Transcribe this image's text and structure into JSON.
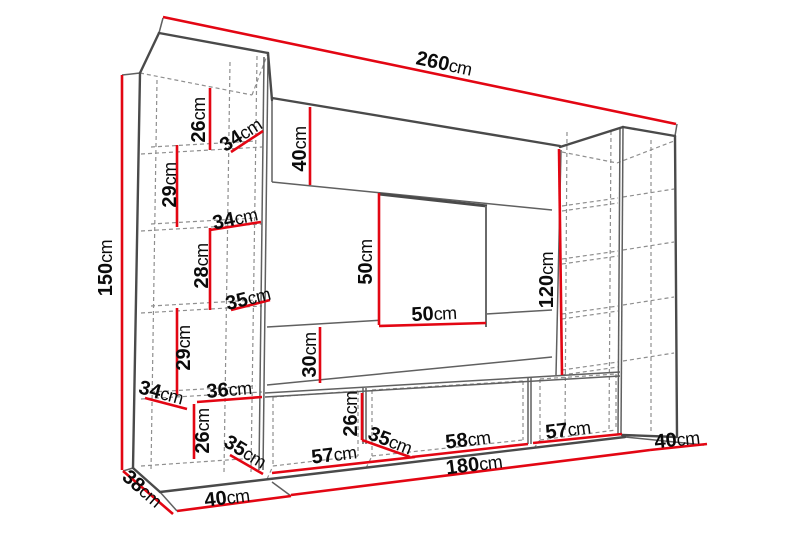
{
  "diagram": {
    "unit": "cm",
    "colors": {
      "dimension_line": "#e30613",
      "outline": "#4a4a4a",
      "outline_thin": "#606060",
      "hidden_line": "#8f8f8f",
      "label_text": "#0b0b0b",
      "background": "#ffffff"
    },
    "dimensions": [
      {
        "id": "overall-width",
        "value": "260",
        "unit": "cm",
        "x": 444,
        "y": 64,
        "rot": 12,
        "line": [
          163,
          17,
          676,
          124
        ]
      },
      {
        "id": "overall-height",
        "value": "150",
        "unit": "cm",
        "x": 106,
        "y": 268,
        "rot": -90,
        "line": [
          122,
          75,
          122,
          470
        ]
      },
      {
        "id": "left-shelf-26",
        "value": "26",
        "unit": "cm",
        "x": 199,
        "y": 120,
        "rot": -90,
        "line": [
          210,
          88,
          210,
          150
        ]
      },
      {
        "id": "left-depth-34a",
        "value": "34",
        "unit": "cm",
        "x": 241,
        "y": 135,
        "rot": -33,
        "line": [
          231,
          152,
          263,
          131
        ]
      },
      {
        "id": "top-panel-40",
        "value": "40",
        "unit": "cm",
        "x": 300,
        "y": 149,
        "rot": -90,
        "line": [
          310,
          107,
          310,
          185
        ]
      },
      {
        "id": "left-shelf-29a",
        "value": "29",
        "unit": "cm",
        "x": 170,
        "y": 185,
        "rot": -90,
        "line": [
          177,
          145,
          177,
          227
        ]
      },
      {
        "id": "left-depth-34b",
        "value": "34",
        "unit": "cm",
        "x": 235,
        "y": 219,
        "rot": -12,
        "line": [
          210,
          230,
          261,
          222
        ]
      },
      {
        "id": "left-shelf-28",
        "value": "28",
        "unit": "cm",
        "x": 202,
        "y": 266,
        "rot": -90,
        "line": [
          210,
          228,
          210,
          310
        ]
      },
      {
        "id": "left-depth-35a",
        "value": "35",
        "unit": "cm",
        "x": 248,
        "y": 299,
        "rot": -14,
        "line": [
          231,
          310,
          270,
          300
        ]
      },
      {
        "id": "tv-height-50",
        "value": "50",
        "unit": "cm",
        "x": 366,
        "y": 262,
        "rot": -90,
        "line": [
          379,
          193,
          379,
          325
        ]
      },
      {
        "id": "tv-width-50",
        "value": "50",
        "unit": "cm",
        "x": 434,
        "y": 314,
        "rot": -3,
        "line": [
          379,
          326,
          486,
          323
        ]
      },
      {
        "id": "right-cabinet-120",
        "value": "120",
        "unit": "cm",
        "x": 547,
        "y": 280,
        "rot": -90,
        "line": [
          559,
          149,
          562,
          375
        ]
      },
      {
        "id": "left-shelf-29b",
        "value": "29",
        "unit": "cm",
        "x": 184,
        "y": 348,
        "rot": -90,
        "line": [
          177,
          308,
          177,
          395
        ]
      },
      {
        "id": "lower-panel-30",
        "value": "30",
        "unit": "cm",
        "x": 310,
        "y": 355,
        "rot": -90,
        "line": [
          320,
          327,
          320,
          383
        ]
      },
      {
        "id": "left-bottom-depth-34",
        "value": "34",
        "unit": "cm",
        "x": 161,
        "y": 393,
        "rot": 15,
        "line": [
          145,
          398,
          187,
          409
        ]
      },
      {
        "id": "left-bottom-width-36",
        "value": "36",
        "unit": "cm",
        "x": 229,
        "y": 390,
        "rot": -5,
        "line": [
          197,
          402,
          262,
          397
        ]
      },
      {
        "id": "left-bottom-height-26",
        "value": "26",
        "unit": "cm",
        "x": 203,
        "y": 431,
        "rot": -90,
        "line": [
          194,
          404,
          194,
          459
        ]
      },
      {
        "id": "bench-left-depth-35",
        "value": "35",
        "unit": "cm",
        "x": 245,
        "y": 452,
        "rot": 31,
        "line": [
          230,
          455,
          263,
          474
        ]
      },
      {
        "id": "bench-compartment-57a",
        "value": "57",
        "unit": "cm",
        "x": 334,
        "y": 455,
        "rot": -7,
        "line": [
          272,
          473,
          415,
          457
        ]
      },
      {
        "id": "bench-divider-26",
        "value": "26",
        "unit": "cm",
        "x": 351,
        "y": 414,
        "rot": -90,
        "line": [
          362,
          393,
          362,
          440
        ]
      },
      {
        "id": "bench-mid-depth-35",
        "value": "35",
        "unit": "cm",
        "x": 390,
        "y": 441,
        "rot": 21,
        "line": [
          362,
          440,
          410,
          457
        ]
      },
      {
        "id": "bench-compartment-58",
        "value": "58",
        "unit": "cm",
        "x": 468,
        "y": 440,
        "rot": -7,
        "line": [
          412,
          457,
          528,
          444
        ]
      },
      {
        "id": "bench-compartment-57b",
        "value": "57",
        "unit": "cm",
        "x": 568,
        "y": 430,
        "rot": -7,
        "line": [
          533,
          443,
          622,
          434
        ]
      },
      {
        "id": "bench-width-180",
        "value": "180",
        "unit": "cm",
        "x": 474,
        "y": 465,
        "rot": -7,
        "line": [
          291,
          495,
          650,
          450
        ]
      },
      {
        "id": "floor-right-40",
        "value": "40",
        "unit": "cm",
        "x": 677,
        "y": 440,
        "rot": -6,
        "line": [
          650,
          450,
          707,
          444
        ]
      },
      {
        "id": "floor-left-40",
        "value": "40",
        "unit": "cm",
        "x": 227,
        "y": 498,
        "rot": -7,
        "line": [
          177,
          511,
          291,
          496
        ]
      },
      {
        "id": "left-side-depth-38",
        "value": "38",
        "unit": "cm",
        "x": 142,
        "y": 489,
        "rot": 41,
        "line": [
          123,
          471,
          173,
          514
        ]
      }
    ]
  }
}
